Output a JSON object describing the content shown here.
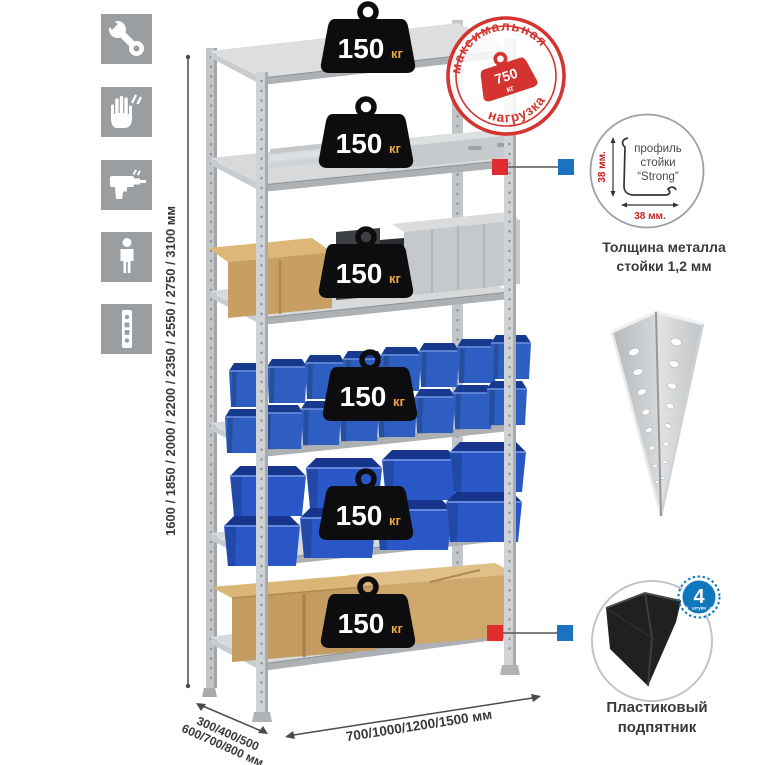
{
  "colors": {
    "accent_red": "#d4332f",
    "callout_red": "#e02b2f",
    "callout_blue": "#1d71c2",
    "icon_tile_gray": "#9b9ea1",
    "badge_black": "#0d0d0f",
    "badge_kg_orange": "#eda73f",
    "bin_blue": "#2e5ec2",
    "cardboard": "#c79f63",
    "metal_gray": "#d7d9db"
  },
  "left_icons": {
    "items": [
      {
        "name": "wrench"
      },
      {
        "name": "gloves"
      },
      {
        "name": "drill"
      },
      {
        "name": "person"
      },
      {
        "name": "rack-post"
      }
    ]
  },
  "dimensions": {
    "height_label": "1600 / 1850 / 2000 / 2200 / 2350 / 2550 / 2750 / 3100 мм",
    "depth_label_line1": "300/400/500",
    "depth_label_line2": "600/700/800 мм",
    "width_label": "700/1000/1200/1500 мм"
  },
  "shelf_badge": {
    "value": "150",
    "unit": "кг",
    "count": 6
  },
  "stamp": {
    "arc_top": "максимальная",
    "arc_bottom": "нагрузка",
    "value": "750",
    "unit": "кг"
  },
  "profile_detail": {
    "dim_vertical": "38 мм.",
    "dim_horizontal": "38 мм.",
    "label_line1": "профиль",
    "label_line2": "стойки",
    "label_line3": "“Strong”",
    "caption_line1": "Толщина металла",
    "caption_line2": "стойки 1,2 мм"
  },
  "foot_detail": {
    "badge_value": "4",
    "badge_sub": "штуки",
    "badge_arc": "в комплекте",
    "caption_line1": "Пластиковый",
    "caption_line2": "подпятник"
  }
}
